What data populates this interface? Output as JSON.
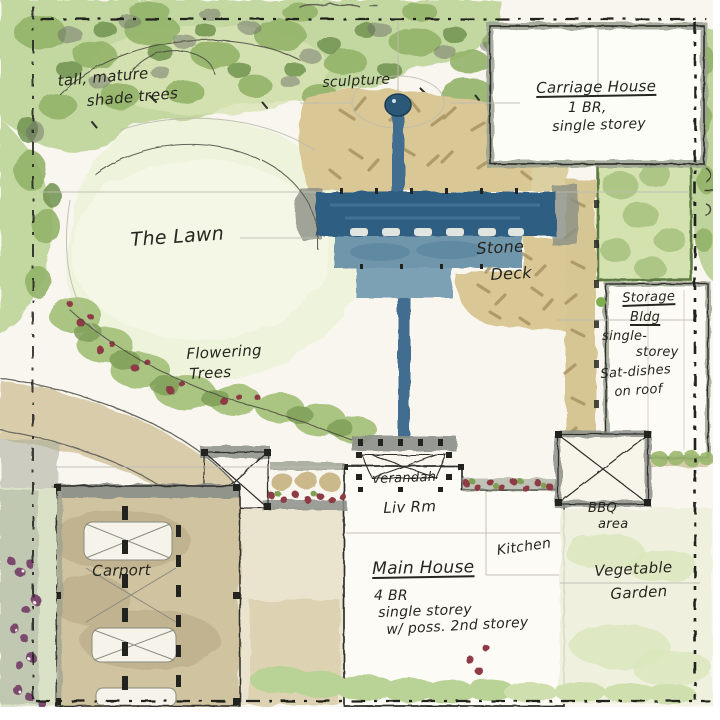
{
  "palette": {
    "paper": "#f8f6ee",
    "foliage_green": "#a9c47e",
    "lawn_green": "#eef3dc",
    "water_blue": "#2f5f82",
    "stone_tan": "#d9c795",
    "wall_gray": "#8b9089",
    "ink": "#26261f",
    "flower_red": "#8e3a45",
    "flower_purple": "#7b4a6e"
  },
  "labels": {
    "shade_trees_line1": "tall, mature",
    "shade_trees_line2": "shade trees",
    "sculpture": "sculpture",
    "carriage_house_name": "Carriage House",
    "carriage_house_line2": "1 BR,",
    "carriage_house_line3": "single storey",
    "lawn": "The Lawn",
    "stone_deck_line1": "Stone",
    "stone_deck_line2": "Deck",
    "storage_line1": "Storage",
    "storage_line2": "Bldg",
    "storage_line3": "single-",
    "storage_line4": "storey",
    "storage_line5": "Sat-dishes",
    "storage_line6": "on roof",
    "flowering_line1": "Flowering",
    "flowering_line2": "Trees",
    "verandah": "verandah",
    "living_room": "Liv Rm",
    "kitchen": "Kitchen",
    "main_house_name": "Main House",
    "main_house_line2": "4 BR",
    "main_house_line3": "single storey",
    "main_house_line4": "w/ poss. 2nd storey",
    "bbq_line1": "BBQ",
    "bbq_line2": "area",
    "vegetable_line1": "Vegetable",
    "vegetable_line2": "Garden",
    "carport": "Carport"
  }
}
